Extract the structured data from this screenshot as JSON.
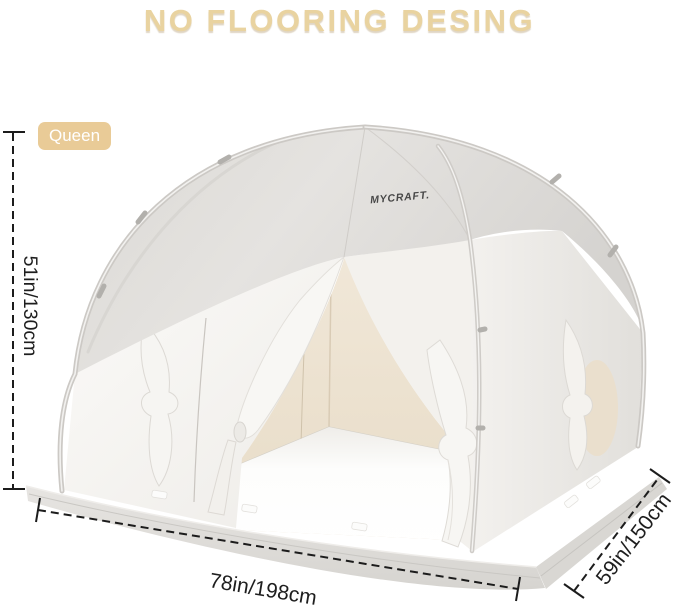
{
  "page": {
    "background_color": "#ffffff"
  },
  "header": {
    "title": "NO FLOORING DESING",
    "title_color": "#e9d3a0"
  },
  "badge": {
    "label": "Queen",
    "background_color": "#e9cb97",
    "text_color": "#ffffff"
  },
  "product": {
    "brand_label": "MYCRAFT.",
    "description": "white indoor bed tent, dome canopy, open front doors tied back, no floor",
    "canopy_color": "#dcdad6",
    "panel_color": "#f8f7f4",
    "interior_color": "#ece1d0"
  },
  "dimensions": {
    "line_color": "#1c1c1c",
    "height_label": "51in/130cm",
    "width_label": "78in/198cm",
    "depth_label": "59in/150cm"
  }
}
